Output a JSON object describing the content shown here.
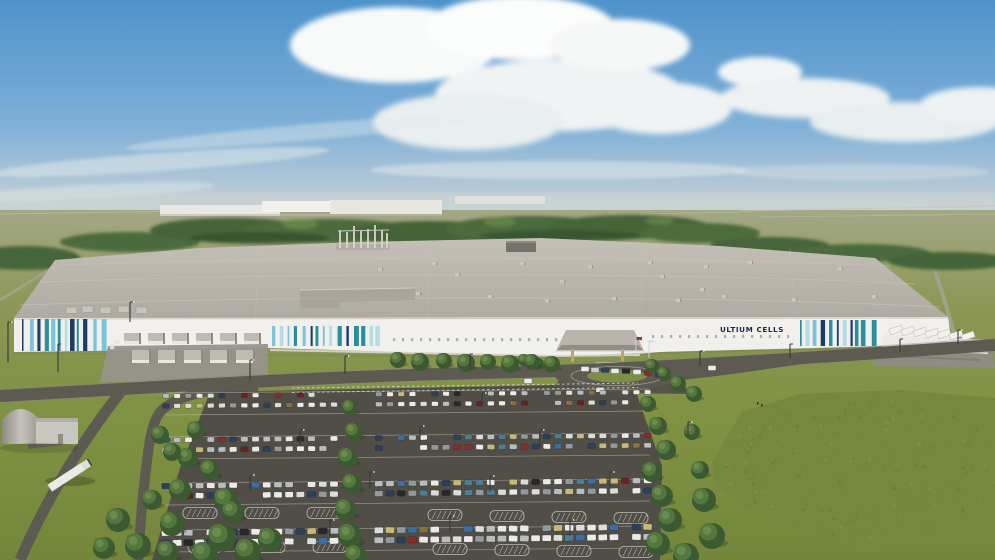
{
  "scene": {
    "kind": "aerial-architectural-rendering",
    "subject": "Ultium Cells battery plant with full parking lot"
  },
  "building": {
    "logo_text": "ULTIUM CELLS",
    "stripe_bands": [
      {
        "x0": 22,
        "x1": 112,
        "y": 319,
        "h": 32,
        "seed": 7
      },
      {
        "x0": 272,
        "x1": 380,
        "y": 326,
        "h": 20,
        "seed": 11
      },
      {
        "x0": 800,
        "x1": 876,
        "y": 320,
        "h": 26,
        "seed": 19
      }
    ],
    "window_rows": [
      {
        "x0": 393,
        "x1": 556,
        "y": 338,
        "step": 9,
        "w": 2.2,
        "h": 3.2
      },
      {
        "x0": 652,
        "x1": 794,
        "y": 335,
        "step": 9,
        "w": 2.2,
        "h": 3.0
      }
    ],
    "roof_units": [
      [
        378,
        268
      ],
      [
        432,
        262
      ],
      [
        455,
        273
      ],
      [
        488,
        295
      ],
      [
        520,
        262
      ],
      [
        545,
        299
      ],
      [
        588,
        265
      ],
      [
        612,
        297
      ],
      [
        648,
        261
      ],
      [
        676,
        299
      ],
      [
        704,
        265
      ],
      [
        722,
        295
      ],
      [
        748,
        261
      ],
      [
        792,
        298
      ],
      [
        838,
        267
      ],
      [
        872,
        295
      ],
      [
        660,
        275
      ],
      [
        560,
        280
      ],
      [
        416,
        292
      ],
      [
        700,
        288
      ]
    ],
    "left_roof_boxes": [
      [
        66,
        307
      ],
      [
        82,
        306
      ],
      [
        100,
        307
      ],
      [
        118,
        306
      ],
      [
        136,
        307
      ]
    ],
    "equipment_rows": [
      {
        "y": 333,
        "x0": 124,
        "n": 6,
        "step": 24,
        "w": 17,
        "h": 11
      },
      {
        "y": 350,
        "x0": 132,
        "n": 5,
        "step": 26,
        "w": 19,
        "h": 13
      }
    ]
  },
  "docks": {
    "trailers": [
      [
        896,
        330
      ],
      [
        908,
        331
      ],
      [
        920,
        332
      ],
      [
        932,
        333
      ],
      [
        944,
        334
      ],
      [
        956,
        335
      ],
      [
        968,
        336
      ]
    ]
  },
  "entrance": {
    "vehicle_palette": [
      "#eceae6",
      "#c9cccd",
      "#2c3f5e",
      "#26282a",
      "#8d2a2a"
    ],
    "vehicles": [
      [
        585,
        369,
        0
      ],
      [
        595,
        370,
        1
      ],
      [
        605,
        370,
        2
      ],
      [
        615,
        371,
        0
      ],
      [
        626,
        371,
        3
      ],
      [
        637,
        372,
        0
      ],
      [
        648,
        373,
        4
      ],
      [
        659,
        375,
        2
      ],
      [
        528,
        381,
        0
      ],
      [
        600,
        390,
        0
      ],
      [
        712,
        368,
        0
      ]
    ]
  },
  "parking": {
    "x0": 166,
    "x1": 648,
    "step": 11.2,
    "empty_rate": 0.13,
    "slope": 0.008,
    "bands": [
      [
        396,
        406
      ],
      [
        440,
        450
      ],
      [
        486,
        496
      ],
      [
        533,
        543
      ]
    ],
    "gaps": [
      [
        336,
        374
      ]
    ],
    "car_colors": [
      [
        "#eceae6",
        30
      ],
      [
        "#dcdcd8",
        12
      ],
      [
        "#b9bdbf",
        14
      ],
      [
        "#93999c",
        9
      ],
      [
        "#2c3f5e",
        7
      ],
      [
        "#3d6da5",
        5
      ],
      [
        "#8d2a2a",
        5
      ],
      [
        "#6e1f1f",
        3
      ],
      [
        "#c9b979",
        5
      ],
      [
        "#26282a",
        5
      ],
      [
        "#4b7f93",
        3
      ],
      [
        "#8a6f3f",
        2
      ]
    ],
    "row_lines": [
      [
        166,
        393,
        650,
        389
      ],
      [
        166,
        415,
        650,
        411
      ],
      [
        166,
        437,
        650,
        433
      ],
      [
        166,
        459,
        650,
        455
      ],
      [
        166,
        483,
        650,
        479
      ],
      [
        166,
        505,
        650,
        501
      ],
      [
        166,
        530,
        650,
        526
      ],
      [
        166,
        552,
        650,
        548
      ]
    ],
    "islands": [
      [
        200,
        513
      ],
      [
        262,
        513
      ],
      [
        324,
        513
      ],
      [
        445,
        515
      ],
      [
        507,
        516
      ],
      [
        569,
        517
      ],
      [
        631,
        518
      ],
      [
        205,
        547
      ],
      [
        268,
        547
      ],
      [
        330,
        547
      ],
      [
        450,
        549
      ],
      [
        512,
        550
      ],
      [
        574,
        551
      ],
      [
        636,
        552
      ]
    ]
  },
  "landscape": {
    "trees": [
      [
        196,
        430,
        9
      ],
      [
        188,
        458,
        10
      ],
      [
        180,
        490,
        11
      ],
      [
        172,
        524,
        12
      ],
      [
        168,
        552,
        11
      ],
      [
        205,
        555,
        13
      ],
      [
        226,
        500,
        12
      ],
      [
        210,
        470,
        10
      ],
      [
        222,
        538,
        14
      ],
      [
        248,
        552,
        13
      ],
      [
        270,
        540,
        12
      ],
      [
        233,
        512,
        11
      ],
      [
        350,
        408,
        8
      ],
      [
        354,
        432,
        9
      ],
      [
        348,
        458,
        10
      ],
      [
        352,
        484,
        10
      ],
      [
        346,
        510,
        11
      ],
      [
        350,
        536,
        12
      ],
      [
        356,
        556,
        11
      ],
      [
        648,
        404,
        8
      ],
      [
        658,
        426,
        9
      ],
      [
        666,
        450,
        10
      ],
      [
        652,
        472,
        10
      ],
      [
        662,
        496,
        11
      ],
      [
        670,
        520,
        12
      ],
      [
        658,
        544,
        12
      ],
      [
        686,
        556,
        13
      ],
      [
        700,
        470,
        9
      ],
      [
        692,
        432,
        8
      ],
      [
        704,
        500,
        12
      ],
      [
        712,
        536,
        13
      ],
      [
        652,
        366,
        7
      ],
      [
        664,
        374,
        7
      ],
      [
        678,
        384,
        8
      ],
      [
        694,
        394,
        8
      ],
      [
        524,
        360,
        6
      ],
      [
        538,
        364,
        6
      ],
      [
        550,
        368,
        5
      ],
      [
        398,
        360,
        8
      ],
      [
        420,
        362,
        9
      ],
      [
        444,
        361,
        8
      ],
      [
        466,
        363,
        9
      ],
      [
        488,
        362,
        8
      ],
      [
        510,
        364,
        9
      ],
      [
        532,
        362,
        8
      ],
      [
        552,
        364,
        8
      ],
      [
        118,
        520,
        12
      ],
      [
        138,
        546,
        13
      ],
      [
        104,
        548,
        11
      ],
      [
        152,
        500,
        10
      ],
      [
        160,
        435,
        9
      ],
      [
        172,
        452,
        9
      ]
    ],
    "poles": [
      [
        8,
        362,
        40
      ],
      [
        58,
        372,
        28
      ],
      [
        130,
        322,
        20
      ],
      [
        250,
        380,
        20
      ],
      [
        345,
        374,
        18
      ],
      [
        470,
        370,
        16
      ],
      [
        700,
        366,
        15
      ],
      [
        790,
        358,
        14
      ],
      [
        900,
        352,
        13
      ],
      [
        958,
        344,
        14
      ],
      [
        300,
        446,
        16
      ],
      [
        420,
        442,
        16
      ],
      [
        540,
        446,
        16
      ],
      [
        250,
        491,
        16
      ],
      [
        370,
        488,
        16
      ],
      [
        490,
        492,
        16
      ],
      [
        610,
        488,
        16
      ],
      [
        330,
        536,
        16
      ],
      [
        450,
        532,
        16
      ],
      [
        570,
        536,
        16
      ],
      [
        688,
        436,
        14
      ],
      [
        482,
        406,
        13
      ]
    ],
    "mound": {
      "cx": 862,
      "cy": 468,
      "rx": 138,
      "ry": 72,
      "count": 240,
      "colors": [
        "#5f7538",
        "#87994f",
        "#6c8040"
      ]
    }
  },
  "palette": {
    "logo_navy": "#16294a",
    "stripe_navy": "#1d3d63",
    "stripe_teal": "#2a8e9b",
    "stripe_light": "#7cc3da",
    "stripe_pale": "#b7dbe6",
    "facade_white": "#f1f0ed",
    "roof_gray": "#b4afa7",
    "asphalt": "#514e47",
    "marking_white": "#d5d2ca",
    "grass_green": "#7f9142",
    "sky_blue": "#4e92ca"
  }
}
